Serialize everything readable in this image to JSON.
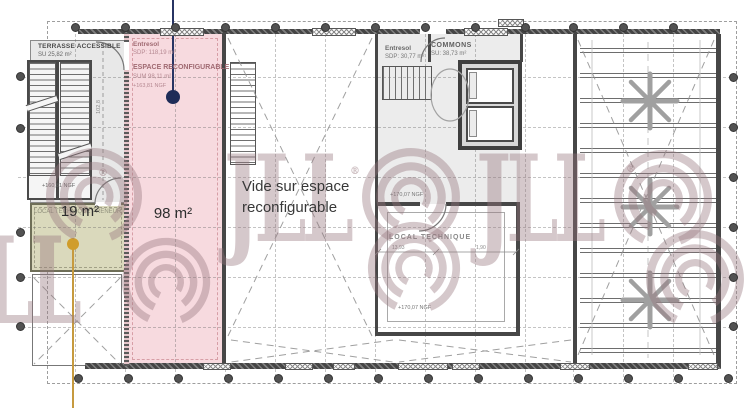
{
  "colors": {
    "zone_pink": "#f7dadf",
    "zone_olive": "#dad9bc",
    "zone_gray": "#e8e8e8",
    "marker_navy": "#1f2c58",
    "marker_orange": "#d09d2b",
    "watermark": "#967478"
  },
  "watermark": {
    "brand": "JLL",
    "registered": "®"
  },
  "labels": {
    "terrasse": {
      "title": "TERRASSE ACCESSIBLE",
      "area": "SU 25,82 m²",
      "ngf": "+160,81 NGF"
    },
    "espace": {
      "level": "Entresol",
      "sdp": "SDP: 118,19 m²",
      "title": "ESPACE RECONFIGURABLE",
      "su": "SUM 98,11 m²",
      "ngf": "+163,81 NGF",
      "badge": "98 m²"
    },
    "local_preneur": {
      "title": "LOCAL TECHNIQUE PRENEUR",
      "badge": "19 m²"
    },
    "vide": {
      "text": "Vide sur espace reconfigurable"
    },
    "entresol": {
      "level": "Entresol",
      "sdp": "SDP: 30,77 m²"
    },
    "commons": {
      "title": "COMMONS",
      "su": "SU: 38,73 m²"
    },
    "local_technique": {
      "title": "LOCAL TECHNIQUE",
      "ngf_upper": "+170,07 NGF",
      "ngf_lower": "+170,07 NGF"
    },
    "dims": {
      "terrasse_height": "102,8",
      "lt_width": "13,93",
      "lt_right": "1,90"
    }
  }
}
